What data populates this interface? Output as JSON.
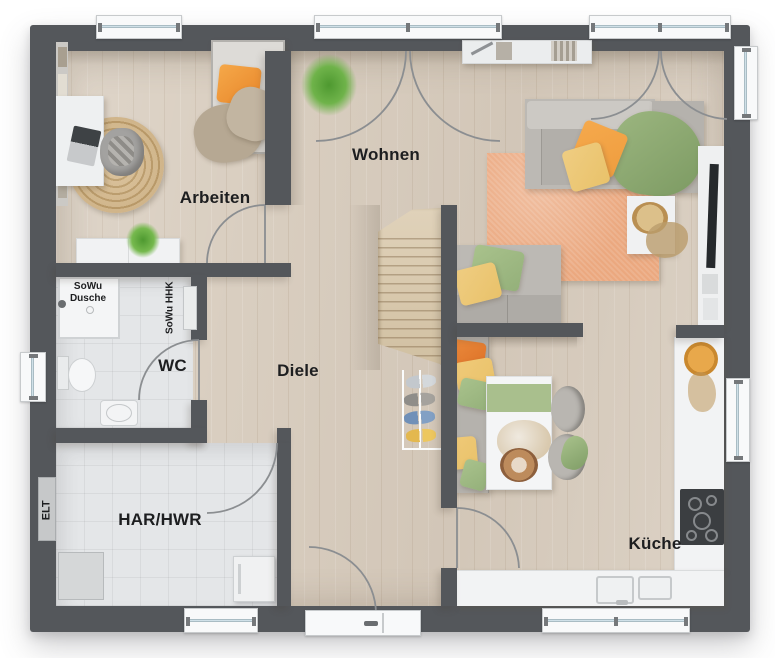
{
  "rooms": [
    {
      "name": "arbeiten",
      "label": "Arbeiten"
    },
    {
      "name": "wohnen",
      "label": "Wohnen"
    },
    {
      "name": "diele",
      "label": "Diele"
    },
    {
      "name": "wc",
      "label": "WC"
    },
    {
      "name": "har-hwr",
      "label": "HAR/HWR"
    },
    {
      "name": "kueche",
      "label": "Küche"
    }
  ],
  "annotations": {
    "shower_line1": "SoWu",
    "shower_line2": "Dusche",
    "heater_label": "SoWu HHK",
    "electrical_label": "ELT"
  },
  "colors": {
    "wall": "#54575b",
    "wood_floor": "#d9cec0",
    "tile_floor": "#e4e6e8",
    "counter": "#f2f3f4",
    "rug": "#eba87f",
    "accent_orange": "#ef9d3f",
    "accent_yellow": "#e9c26a",
    "accent_green": "#94b07a",
    "window_glass": "#cfe0e8"
  }
}
